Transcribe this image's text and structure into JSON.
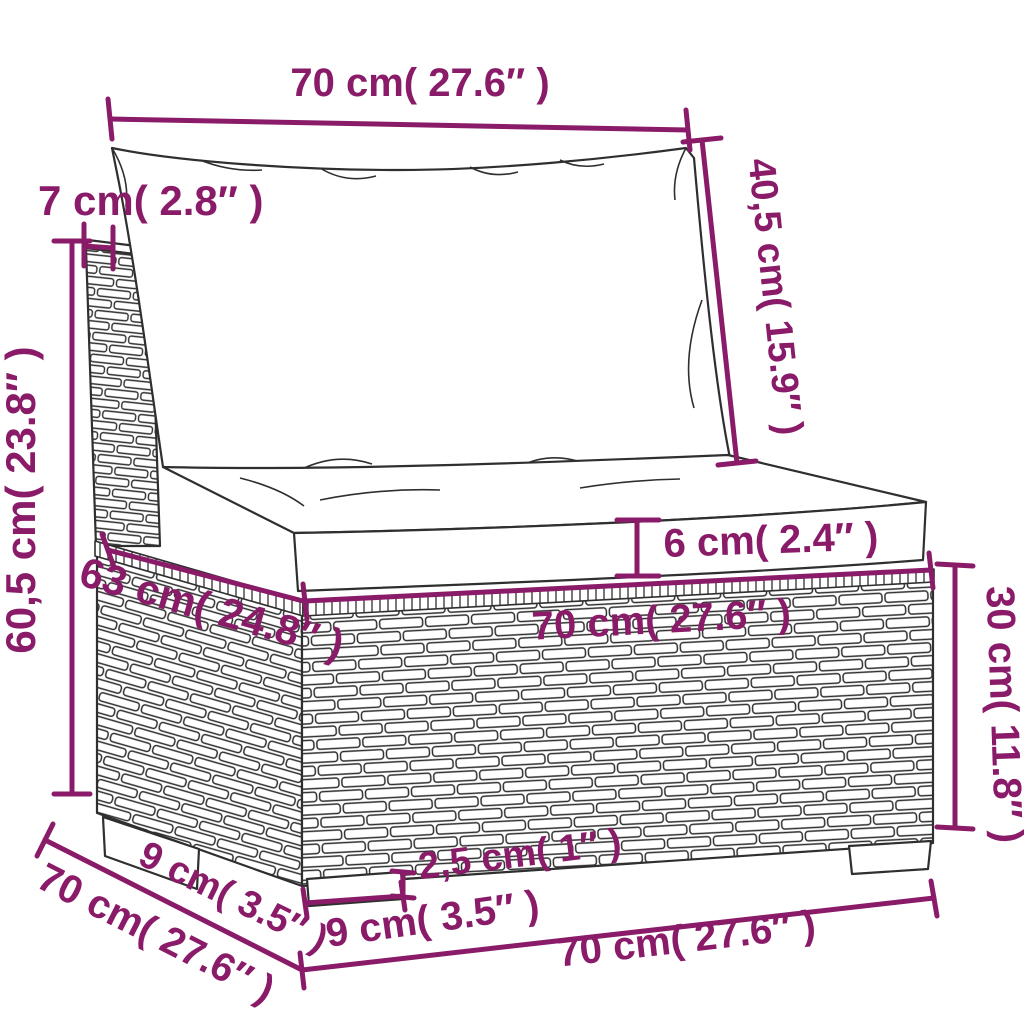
{
  "accent_color": "#8a1b68",
  "line_art_color": "#2f2f2f",
  "dims": {
    "back_width": "70 cm( 27.6″ )",
    "frame_top": "7 cm( 2.8″ )",
    "back_cushion_height": "40,5 cm( 15.9″ )",
    "total_height": "60,5 cm( 23.8″ )",
    "seat_cushion_thickness": "6 cm( 2.4″ )",
    "seat_width": "70 cm( 27.6″ )",
    "seat_depth": "63 cm( 24.8″ )",
    "base_height": "30 cm( 11.8″ )",
    "leg_height": "2,5 cm( 1″ )",
    "leg_depth": "9 cm( 3.5″ )",
    "leg_width": "9 cm( 3.5″ )",
    "total_depth": "70 cm( 27.6″ )",
    "base_width": "70 cm( 27.6″ )"
  }
}
